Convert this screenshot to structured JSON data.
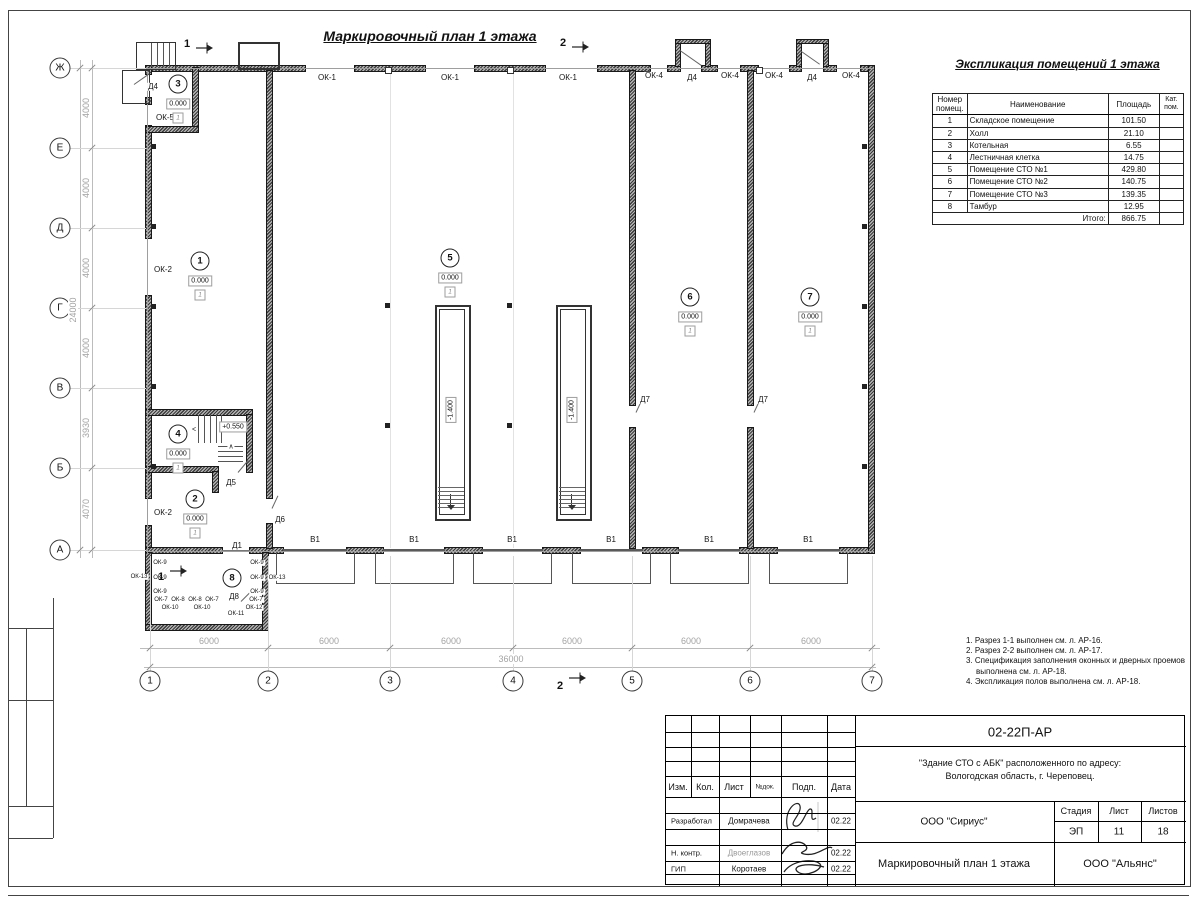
{
  "titles": {
    "plan": "Маркировочный план 1 этажа",
    "expl": "Экспликация помещений 1 этажа"
  },
  "expl_table": {
    "headers": [
      "Номер помещ.",
      "Наименование",
      "Площадь",
      "Кат. пом."
    ],
    "rows": [
      [
        "1",
        "Складское помещение",
        "101.50",
        ""
      ],
      [
        "2",
        "Холл",
        "21.10",
        ""
      ],
      [
        "3",
        "Котельная",
        "6.55",
        ""
      ],
      [
        "4",
        "Лестничная клетка",
        "14.75",
        ""
      ],
      [
        "5",
        "Помещение СТО №1",
        "429.80",
        ""
      ],
      [
        "6",
        "Помещение СТО №2",
        "140.75",
        ""
      ],
      [
        "7",
        "Помещение СТО №3",
        "139.35",
        ""
      ],
      [
        "8",
        "Тамбур",
        "12.95",
        ""
      ]
    ],
    "total_label": "Итого:",
    "total_value": "866.75"
  },
  "notes": [
    "1. Разрез 1-1 выполнен см. л. АР-16.",
    "2. Разрез 2-2 выполнен см. л. АР-17.",
    "3. Спецификация заполнения оконных и дверных проемов выполнена см. л. АР-18.",
    "4. Экспликация полов выполнена см. л. АР-18."
  ],
  "stamp": {
    "doc_number": "02-22П-АР",
    "project_line1": "\"Здание СТО с АБК\" расположенного по адресу:",
    "project_line2": "Вологодская область, г. Череповец.",
    "org1": "ООО \"Сириус\"",
    "org2": "ООО \"Альянс\"",
    "drawing_name": "Маркировочный план 1 этажа",
    "stage_label": "Стадия",
    "sheet_label": "Лист",
    "sheets_label": "Листов",
    "stage": "ЭП",
    "sheet": "11",
    "sheets": "18",
    "col_headers": [
      "Изм.",
      "Кол.",
      "Лист",
      "№док.",
      "Подп.",
      "Дата"
    ],
    "rows": [
      {
        "role": "Разработал",
        "name": "Домрачева",
        "date": "02.22"
      },
      {
        "role": "Н. контр.",
        "name": "Двоеглазов",
        "date": "02.22"
      },
      {
        "role": "ГИП",
        "name": "Коротаев",
        "date": "02.22"
      }
    ]
  },
  "plan": {
    "axes_left": [
      {
        "l": "Ж",
        "y": 68
      },
      {
        "l": "Е",
        "y": 148
      },
      {
        "l": "Д",
        "y": 228
      },
      {
        "l": "Г",
        "y": 308
      },
      {
        "l": "В",
        "y": 388
      },
      {
        "l": "Б",
        "y": 468
      },
      {
        "l": "А",
        "y": 550
      }
    ],
    "axes_bottom": [
      {
        "l": "1",
        "x": 150
      },
      {
        "l": "2",
        "x": 268
      },
      {
        "l": "3",
        "x": 390
      },
      {
        "l": "4",
        "x": 513
      },
      {
        "l": "5",
        "x": 632
      },
      {
        "l": "6",
        "x": 750
      },
      {
        "l": "7",
        "x": 872
      }
    ],
    "dims_left": [
      {
        "v": "4000",
        "y": 108
      },
      {
        "v": "4000",
        "y": 188
      },
      {
        "v": "4000",
        "y": 268
      },
      {
        "v": "4000",
        "y": 348
      },
      {
        "v": "3930",
        "y": 428
      },
      {
        "v": "4070",
        "y": 509
      }
    ],
    "total_left": {
      "v": "24000",
      "y": 310
    },
    "dims_bottom": [
      {
        "v": "6000",
        "x": 209
      },
      {
        "v": "6000",
        "x": 329
      },
      {
        "v": "6000",
        "x": 451
      },
      {
        "v": "6000",
        "x": 572
      },
      {
        "v": "6000",
        "x": 691
      },
      {
        "v": "6000",
        "x": 811
      }
    ],
    "total_bottom": {
      "v": "36000",
      "x": 511
    },
    "rooms": [
      {
        "n": "1",
        "x": 200,
        "y": 261,
        "elev": "0.000",
        "floor": "1"
      },
      {
        "n": "2",
        "x": 195,
        "y": 499,
        "elev": "0.000",
        "floor": "1"
      },
      {
        "n": "3",
        "x": 178,
        "y": 84,
        "elev": "0.000",
        "floor": "1"
      },
      {
        "n": "4",
        "x": 178,
        "y": 434,
        "elev": "0.000",
        "floor": "1"
      },
      {
        "n": "5",
        "x": 450,
        "y": 258,
        "elev": "0.000",
        "floor": "1"
      },
      {
        "n": "6",
        "x": 690,
        "y": 297,
        "elev": "0.000",
        "floor": "1"
      },
      {
        "n": "7",
        "x": 810,
        "y": 297,
        "elev": "0.000",
        "floor": "1"
      },
      {
        "n": "8",
        "x": 232,
        "y": 578
      }
    ],
    "pit_elevations": [
      {
        "v": "-1.400",
        "x": 451,
        "y": 410
      },
      {
        "v": "-1.400",
        "x": 572,
        "y": 410
      }
    ],
    "landing_elevation": {
      "v": "+0.550",
      "x": 233,
      "y": 427
    },
    "labels": [
      {
        "t": "ОК-1",
        "x": 327,
        "y": 78
      },
      {
        "t": "ОК-1",
        "x": 450,
        "y": 78
      },
      {
        "t": "ОК-1",
        "x": 568,
        "y": 78
      },
      {
        "t": "ОК-4",
        "x": 654,
        "y": 76
      },
      {
        "t": "Д4",
        "x": 692,
        "y": 78
      },
      {
        "t": "ОК-4",
        "x": 730,
        "y": 76
      },
      {
        "t": "ОК-4",
        "x": 774,
        "y": 76
      },
      {
        "t": "Д4",
        "x": 812,
        "y": 78
      },
      {
        "t": "ОК-4",
        "x": 851,
        "y": 76
      },
      {
        "t": "Д4",
        "x": 153,
        "y": 87
      },
      {
        "t": "ОК-5",
        "x": 165,
        "y": 118
      },
      {
        "t": "ОК-2",
        "x": 163,
        "y": 270
      },
      {
        "t": "ОК-2",
        "x": 163,
        "y": 513
      },
      {
        "t": "Д5",
        "x": 231,
        "y": 483
      },
      {
        "t": "Д6",
        "x": 280,
        "y": 520
      },
      {
        "t": "Д1",
        "x": 237,
        "y": 546
      },
      {
        "t": "Д8",
        "x": 234,
        "y": 597
      },
      {
        "t": "Д7",
        "x": 645,
        "y": 400
      },
      {
        "t": "Д7",
        "x": 763,
        "y": 400
      },
      {
        "t": "В1",
        "x": 315,
        "y": 540
      },
      {
        "t": "В1",
        "x": 414,
        "y": 540
      },
      {
        "t": "В1",
        "x": 512,
        "y": 540
      },
      {
        "t": "В1",
        "x": 611,
        "y": 540
      },
      {
        "t": "В1",
        "x": 709,
        "y": 540
      },
      {
        "t": "В1",
        "x": 808,
        "y": 540
      },
      {
        "t": "ОК-9",
        "x": 160,
        "y": 563,
        "fs": 6
      },
      {
        "t": "ОК-9",
        "x": 160,
        "y": 578,
        "fs": 6
      },
      {
        "t": "ОК-9",
        "x": 160,
        "y": 592,
        "fs": 6
      },
      {
        "t": "ОК-13",
        "x": 139,
        "y": 577,
        "fs": 6
      },
      {
        "t": "ОК-7",
        "x": 161,
        "y": 600,
        "fs": 6
      },
      {
        "t": "ОК-8",
        "x": 178,
        "y": 600,
        "fs": 6
      },
      {
        "t": "ОК-8",
        "x": 195,
        "y": 600,
        "fs": 6
      },
      {
        "t": "ОК-7",
        "x": 212,
        "y": 600,
        "fs": 6
      },
      {
        "t": "ОК-10",
        "x": 170,
        "y": 608,
        "fs": 6
      },
      {
        "t": "ОК-10",
        "x": 202,
        "y": 608,
        "fs": 6
      },
      {
        "t": "ОК-11",
        "x": 236,
        "y": 614,
        "fs": 6
      },
      {
        "t": "ОК-12",
        "x": 254,
        "y": 608,
        "fs": 6
      },
      {
        "t": "ОК-9",
        "x": 257,
        "y": 563,
        "fs": 6
      },
      {
        "t": "ОК-9",
        "x": 257,
        "y": 578,
        "fs": 6
      },
      {
        "t": "ОК-13",
        "x": 277,
        "y": 578,
        "fs": 6
      },
      {
        "t": "ОК-9",
        "x": 257,
        "y": 592,
        "fs": 6
      },
      {
        "t": "ОК-7",
        "x": 256,
        "y": 600,
        "fs": 6
      },
      {
        "t": "<",
        "x": 194,
        "y": 430,
        "fs": 7
      },
      {
        "t": "∧",
        "x": 231,
        "y": 447,
        "fs": 7
      }
    ],
    "section_marks": [
      {
        "n": "1",
        "x": 187,
        "y": 44,
        "ax": 196,
        "ay": 47
      },
      {
        "n": "2",
        "x": 563,
        "y": 43,
        "ax": 572,
        "ay": 46
      },
      {
        "n": "2",
        "x": 560,
        "y": 686,
        "ax": 569,
        "ay": 677
      },
      {
        "n": "1",
        "x": 161,
        "y": 577,
        "ax": 170,
        "ay": 570
      }
    ]
  }
}
